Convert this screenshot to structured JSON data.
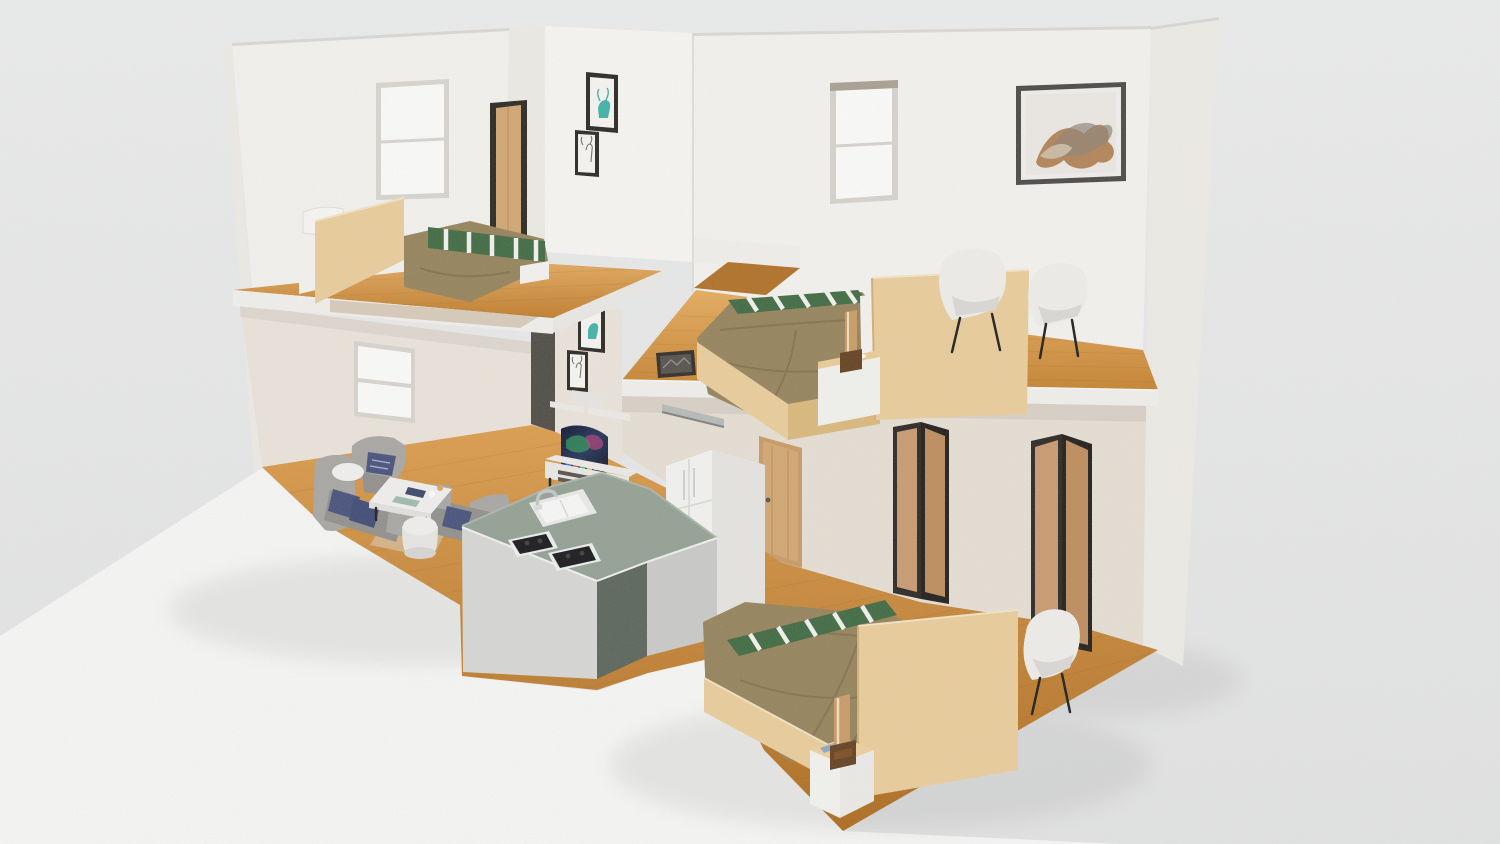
{
  "scene": {
    "type": "3d-isometric-apartment-cutaway-render",
    "rooms": [
      {
        "name": "bedroom-upper-left",
        "furniture": [
          "double-bed",
          "wood-headboard-panel",
          "white-pillows",
          "brown-blanket",
          "green-striped-runner",
          "window",
          "open-wood-door",
          "deer-art-frame-pair"
        ]
      },
      {
        "name": "bedroom-middle",
        "furniture": [
          "double-bed",
          "wood-headboard-panel",
          "brown-blanket",
          "green-striped-runner",
          "wood-bedside-lamp",
          "white-nightstand",
          "armchair",
          "armchair",
          "window",
          "abstract-art-frame"
        ]
      },
      {
        "name": "living-room",
        "furniture": [
          "gray-sofa",
          "gray-loveseat",
          "gray-armchair",
          "navy-pillows",
          "white-coffee-table",
          "round-drum-table",
          "area-rug",
          "curved-tv",
          "tv-console",
          "wall-shelves",
          "deer-art-frame-pair",
          "window"
        ]
      },
      {
        "name": "kitchen",
        "furniture": [
          "l-shaped-island",
          "sink",
          "chrome-faucet",
          "gas-hob-pair",
          "refrigerator",
          "pantry-cabinet",
          "wood-door",
          "metal-wall-bar"
        ]
      },
      {
        "name": "bedroom-lower",
        "furniture": [
          "double-bed",
          "wood-footboard-panel",
          "brown-blanket",
          "green-striped-runner",
          "wood-bedside-lamp",
          "nightstand",
          "smartphone",
          "white-armchair",
          "folding-screen",
          "folding-screen"
        ]
      }
    ],
    "palette": {
      "background": "#e8e9e9",
      "base_white": "#f7f7f6",
      "wall_white": "#f3f2ef",
      "wall_bright": "#f7f6f3",
      "wall_dim": "#edebe6",
      "wall_beige": "#eae3da",
      "wall_beige_dark": "#e6ded3",
      "wall_edge_dark": "#4e4a44",
      "wall_top_edge": "#d9d8d4",
      "fascia_white": "#f0efec",
      "floor_light": "#e0a457",
      "floor_mid": "#cd8b3b",
      "floor_dark": "#b57527",
      "floor_hall": "#b06f26",
      "bed_wood": "#e9cc9a",
      "bed_wood_dark": "#d9b87b",
      "blanket_brown": "#94825a",
      "stripe_green": "#3e6941",
      "white_soft": "#f4f3f1",
      "sofa_gray": "#a7a6a3",
      "sofa_gray_dark": "#908f8c",
      "pillow_navy": "#46517b",
      "counter_sage": "#93a093",
      "counter_sage_dark": "#59645a",
      "counter_face": "#d6d7d4",
      "fridge_white": "#f2f2f0",
      "fridge_side": "#e5e4e0",
      "door_wood": "#d2a672",
      "door_frame": "#c89a64",
      "frame_dark": "#2a2723",
      "frame_gray": "#4a4846",
      "screen_tan": "#c89a6f",
      "screen_tan_dark": "#bd8c5c",
      "art_teal": "#3fb3a5",
      "art_orange": "#a8713d",
      "chair_white": "#eeedea",
      "chair_shade": "#d9d8d4",
      "metal": "#b7b9b8",
      "lamp_wood": "#c99a66",
      "lamp_base": "#63401f",
      "phone_blue": "#93a6c6",
      "tv_screen": "#141b33",
      "console_white": "#eceae7",
      "table_white": "#f0efed",
      "rug_beige": "#d9cfc0",
      "mattress_white": "#f3f2ef"
    }
  }
}
